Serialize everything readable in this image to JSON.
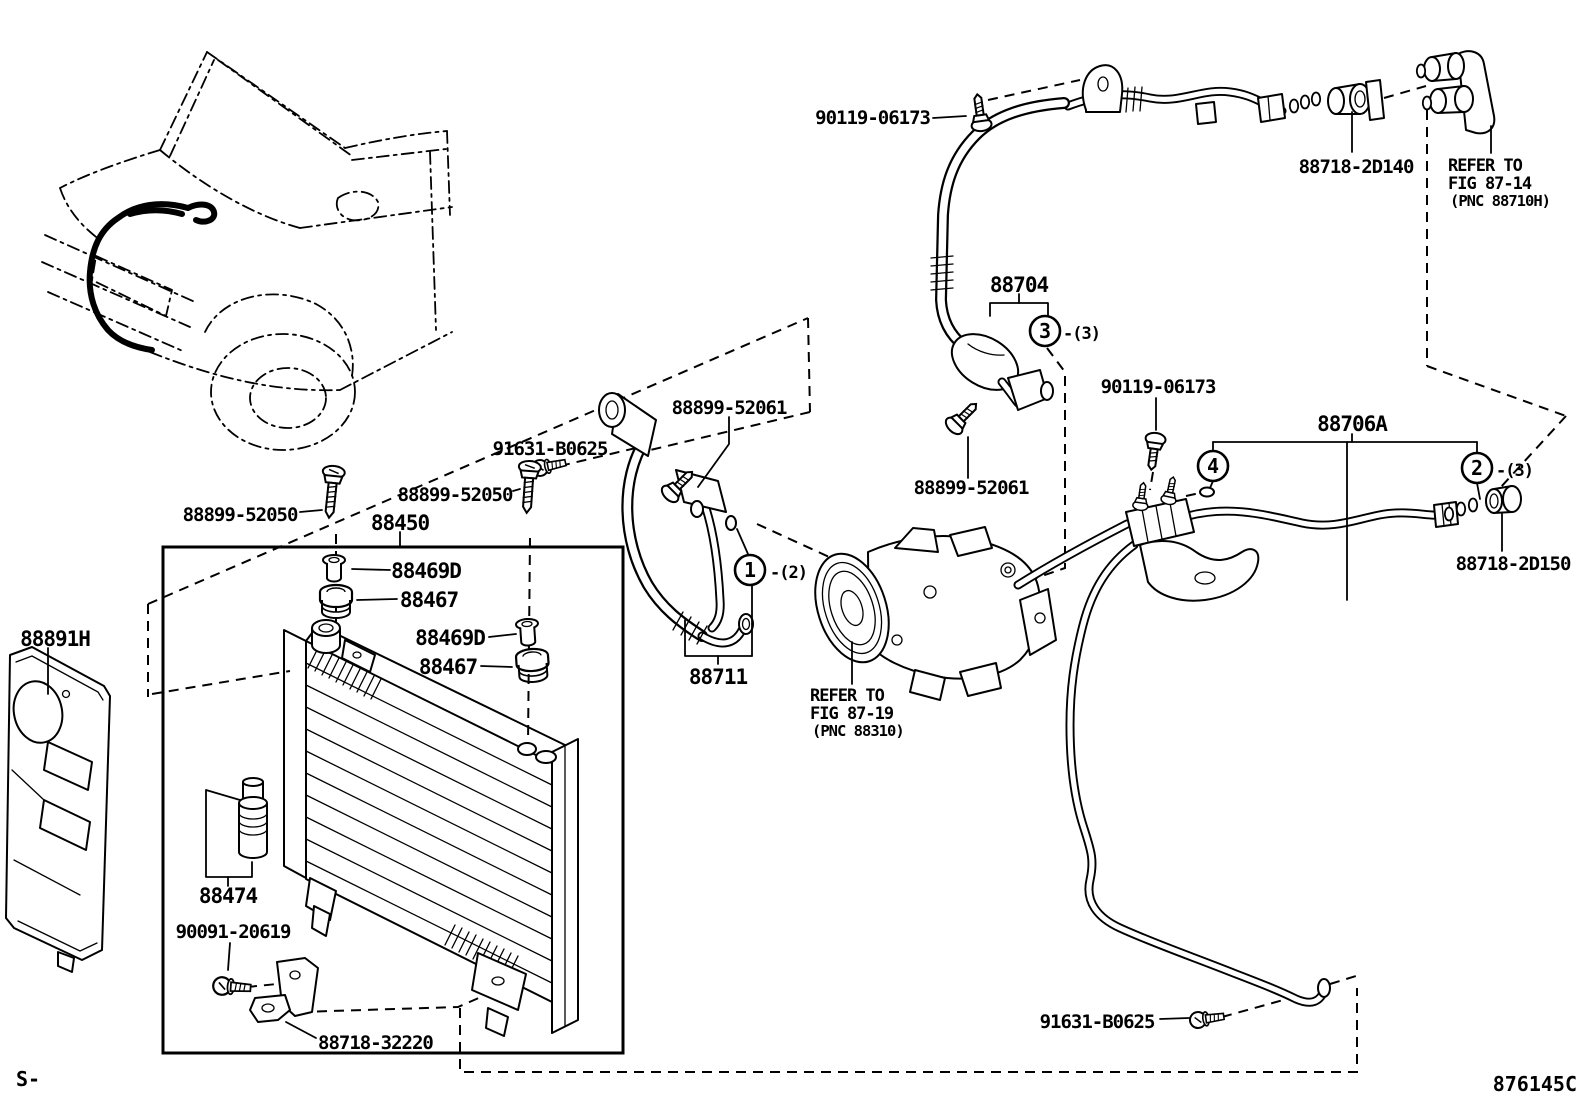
{
  "figure": {
    "code": "876145C",
    "footer_prefix": "S-"
  },
  "labels": {
    "p90119_06173_top": "90119-06173",
    "p90119_06173_mid": "90119-06173",
    "p88718_2d140": "88718-2D140",
    "p88704": "88704",
    "p88706a": "88706A",
    "p88718_2d150": "88718-2D150",
    "p88899_52061_a": "88899-52061",
    "p88899_52061_b": "88899-52061",
    "p91631_b0625_a": "91631-B0625",
    "p91631_b0625_b": "91631-B0625",
    "p88899_52050_a": "88899-52050",
    "p88899_52050_b": "88899-52050",
    "p88450": "88450",
    "p88469d_a": "88469D",
    "p88467_a": "88467",
    "p88469d_b": "88469D",
    "p88467_b": "88467",
    "p88711": "88711",
    "p88891h": "88891H",
    "p88474": "88474",
    "p90091_20619": "90091-20619",
    "p88718_32220": "88718-32220"
  },
  "references": {
    "fig_87_14": {
      "l1": "REFER TO",
      "l2": "FIG 87-14",
      "l3": "(PNC 88710H)"
    },
    "fig_87_19": {
      "l1": "REFER TO",
      "l2": "FIG 87-19",
      "l3": "(PNC 88310)"
    }
  },
  "callouts": {
    "c1": {
      "num": "1",
      "qty": "-(2)"
    },
    "c2": {
      "num": "2",
      "qty": "-(3)"
    },
    "c3": {
      "num": "3",
      "qty": "-(3)"
    },
    "c4": {
      "num": "4",
      "qty": ""
    }
  },
  "colors": {
    "ink": "#000000",
    "paper": "#ffffff"
  }
}
